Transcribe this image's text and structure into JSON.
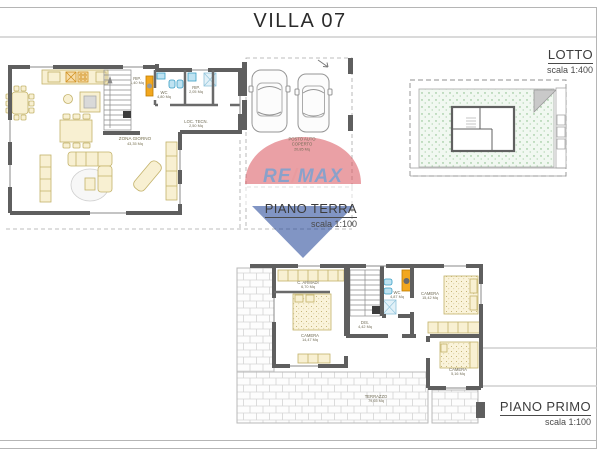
{
  "page": {
    "title": "VILLA 07"
  },
  "watermark": {
    "brand_re": "RE",
    "brand_slash": "/",
    "brand_max": "MAX"
  },
  "colors": {
    "wall": "#5f5f5f",
    "furniture": "#f8f0d2",
    "furniture_stroke": "#c3b26a",
    "fixture_blue": "#3a9ec4",
    "accent_orange": "#f2a71e",
    "lawn_green": "#7fb77f",
    "remax_blue": "#2b55a0",
    "remax_red": "#d84a52"
  },
  "plans": {
    "terra": {
      "label": "PIANO TERRA",
      "scale": "scala 1:100",
      "rooms": [
        {
          "name": "ZONA GIORNO",
          "area": "43,35 Mq"
        },
        {
          "name": "RIP.",
          "area": "1,40 Mq"
        },
        {
          "name": "WC",
          "area": "4,80 Mq"
        },
        {
          "name": "RIP.",
          "area": "2,05 Mq"
        },
        {
          "name": "LOC. TECN.",
          "area": "2,50 Mq"
        },
        {
          "name": "POSTO AUTO",
          "name2": "COPERTO",
          "area": "20,85 Mq"
        }
      ]
    },
    "primo": {
      "label": "PIANO PRIMO",
      "scale": "scala 1:100",
      "rooms": [
        {
          "name": "C. ARMADI",
          "area": "6,70 Mq"
        },
        {
          "name": "CAMERA",
          "area": "14,47 Mq"
        },
        {
          "name": "WC",
          "area": "4,87 Mq"
        },
        {
          "name": "DIS.",
          "area": "4,42 Mq"
        },
        {
          "name": "CAMERA",
          "area": "15,42 Mq"
        },
        {
          "name": "CAMERA",
          "area": "5,16 Mq"
        },
        {
          "name": "TERRAZZO",
          "area": "79,65 Mq"
        }
      ]
    },
    "lotto": {
      "label": "LOTTO",
      "scale": "scala 1:400"
    }
  }
}
